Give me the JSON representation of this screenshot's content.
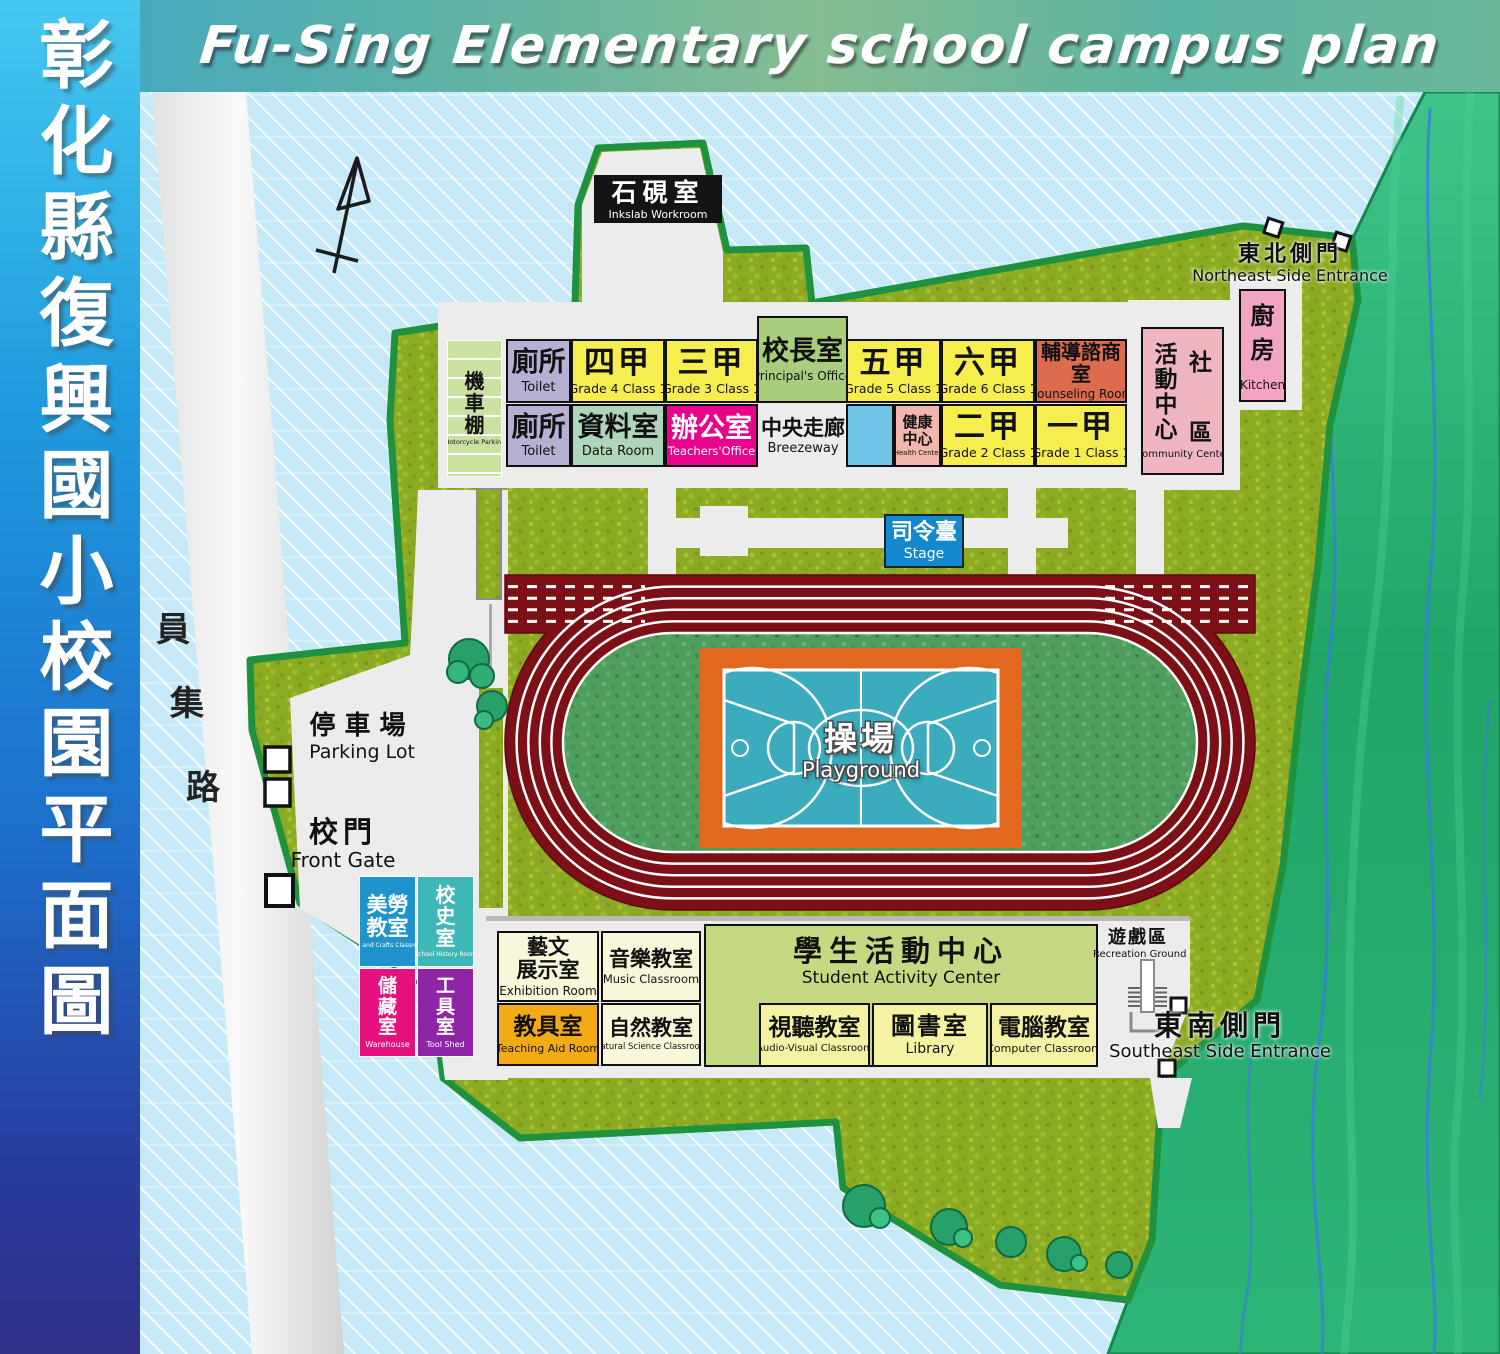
{
  "header": {
    "title": "Fu-Sing Elementary school campus plan"
  },
  "sidebar": {
    "title": "彰化縣復興國小校園平面圖"
  },
  "road": {
    "c1": "員",
    "c2": "集",
    "c3": "路"
  },
  "labels": {
    "inkslab": {
      "zh": "石硯室",
      "en": "Inkslab Workroom"
    },
    "northeast_entrance": {
      "zh": "東北側門",
      "en": "Northeast Side Entrance"
    },
    "southeast_entrance": {
      "zh": "東南側門",
      "en": "Southeast Side Entrance"
    },
    "parking_lot": {
      "zh": "停車場",
      "en": "Parking Lot"
    },
    "front_gate": {
      "zh": "校門",
      "en": "Front Gate"
    },
    "stage": {
      "zh": "司令臺",
      "en": "Stage"
    },
    "playground": {
      "zh": "操場",
      "en": "Playground"
    },
    "recreation_ground": {
      "zh": "遊戲區",
      "en": "Recreation Ground"
    },
    "motorcycle_parking": {
      "zh": "機\n車\n棚",
      "en": "Motorcycle Parking"
    },
    "breezeway": {
      "zh": "中央走廊",
      "en": "Breezeway"
    }
  },
  "rooms": {
    "toilet_north": {
      "zh": "廁所",
      "en": "Toilet"
    },
    "toilet_south": {
      "zh": "廁所",
      "en": "Toilet"
    },
    "grade4": {
      "zh": "四甲",
      "en": "Grade 4 Class 1"
    },
    "grade3": {
      "zh": "三甲",
      "en": "Grade 3 Class 1"
    },
    "principal": {
      "zh": "校長室",
      "en": "Principal's Office"
    },
    "grade5": {
      "zh": "五甲",
      "en": "Grade 5 Class 1"
    },
    "grade6": {
      "zh": "六甲",
      "en": "Grade 6 Class 1"
    },
    "counseling": {
      "zh": "輔導諮商室",
      "en": "Counseling Room"
    },
    "data_room": {
      "zh": "資料室",
      "en": "Data Room"
    },
    "teachers_office": {
      "zh": "辦公室",
      "en": "Teachers'Office"
    },
    "health_center": {
      "zh": "健康\n中心",
      "en": "Health Center"
    },
    "grade2": {
      "zh": "二甲",
      "en": "Grade 2 Class 1"
    },
    "grade1": {
      "zh": "一甲",
      "en": "Grade 1 Class 1"
    },
    "community_center": {
      "zh_col_left": "活動中心",
      "zh_top_right": "社",
      "zh_bottom_right": "區",
      "en": "Community Center"
    },
    "kitchen": {
      "zh": "廚\n房",
      "en": "Kitchen"
    },
    "arts_crafts": {
      "zh": "美勞\n教室",
      "en": "Arts and Crafts Classroom"
    },
    "school_history": {
      "zh": "校\n史\n室",
      "en": "School History Room"
    },
    "warehouse": {
      "zh": "儲\n藏\n室",
      "en": "Warehouse"
    },
    "tool_shed": {
      "zh": "工\n具\n室",
      "en": "Tool Shed"
    },
    "exhibition": {
      "zh": "藝文\n展示室",
      "en": "Exhibition Room"
    },
    "music": {
      "zh": "音樂教室",
      "en": "Music Classroom"
    },
    "teaching_aid": {
      "zh": "教具室",
      "en": "Teaching Aid Room"
    },
    "natural_science": {
      "zh": "自然教室",
      "en": "Natural Science Classroom"
    },
    "student_activity": {
      "zh": "學生活動中心",
      "en": "Student Activity Center"
    },
    "audio_visual": {
      "zh": "視聽教室",
      "en": "Audio-Visual Classroom"
    },
    "library": {
      "zh": "圖書室",
      "en": "Library"
    },
    "computer": {
      "zh": "電腦教室",
      "en": "Computer Classroom"
    }
  },
  "colors": {
    "classroom_yellow": "#f6ee4e",
    "toilet_lavender": "#b7b0d4",
    "principal_green": "#a9cd7c",
    "data_room_green": "#afd6bb",
    "teachers_office_magenta": "#e9038a",
    "counseling_orange": "#dd6b4e",
    "health_pink": "#f3b6ac",
    "community_pink": "#efb6c2",
    "kitchen_pink": "#f3a4c3",
    "stage_blue": "#1488cf",
    "track_red": "#7c1016",
    "court_teal": "#3aacbe",
    "court_border_orange": "#e2681f",
    "campus_grass": "#8cab22",
    "terrain_green": "#2ab374",
    "background_blue": "#c5e9f6"
  }
}
